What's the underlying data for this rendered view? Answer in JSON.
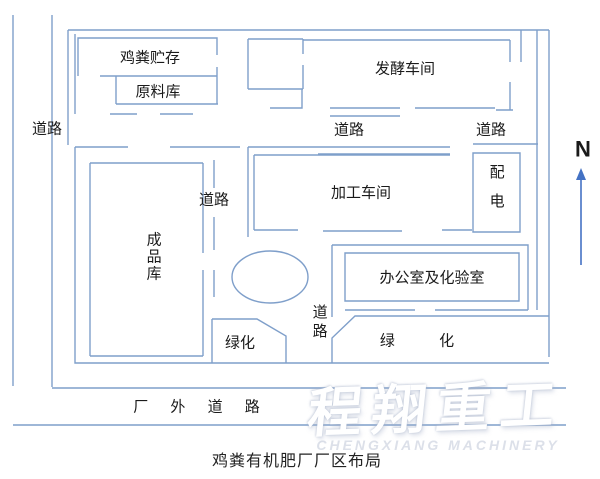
{
  "diagram": {
    "caption": "鸡粪有机肥厂厂区布局",
    "compass": {
      "label": "N"
    },
    "areas": {
      "manure_storage": "鸡粪贮存",
      "raw_material": "原料库",
      "fermentation": "发酵车间",
      "processing": "加工车间",
      "power": "配电",
      "finished_goods": "成品库",
      "office_lab": "办公室及化验室",
      "green_left": "绿化",
      "green_right": "绿 化",
      "outside_road": "厂 外 道 路"
    },
    "roads": {
      "left": "道路",
      "top_middle": "道路",
      "top_right": "道路",
      "mid_left": "道路",
      "mid_vertical": "道路"
    },
    "watermark": {
      "text": "程翔重工",
      "subtext": "CHENGXIANG MACHINERY"
    },
    "colors": {
      "line": "#7f9fca",
      "arrow": "#4472c4",
      "text": "#1a1a1a",
      "watermark": "#ffffff"
    }
  }
}
